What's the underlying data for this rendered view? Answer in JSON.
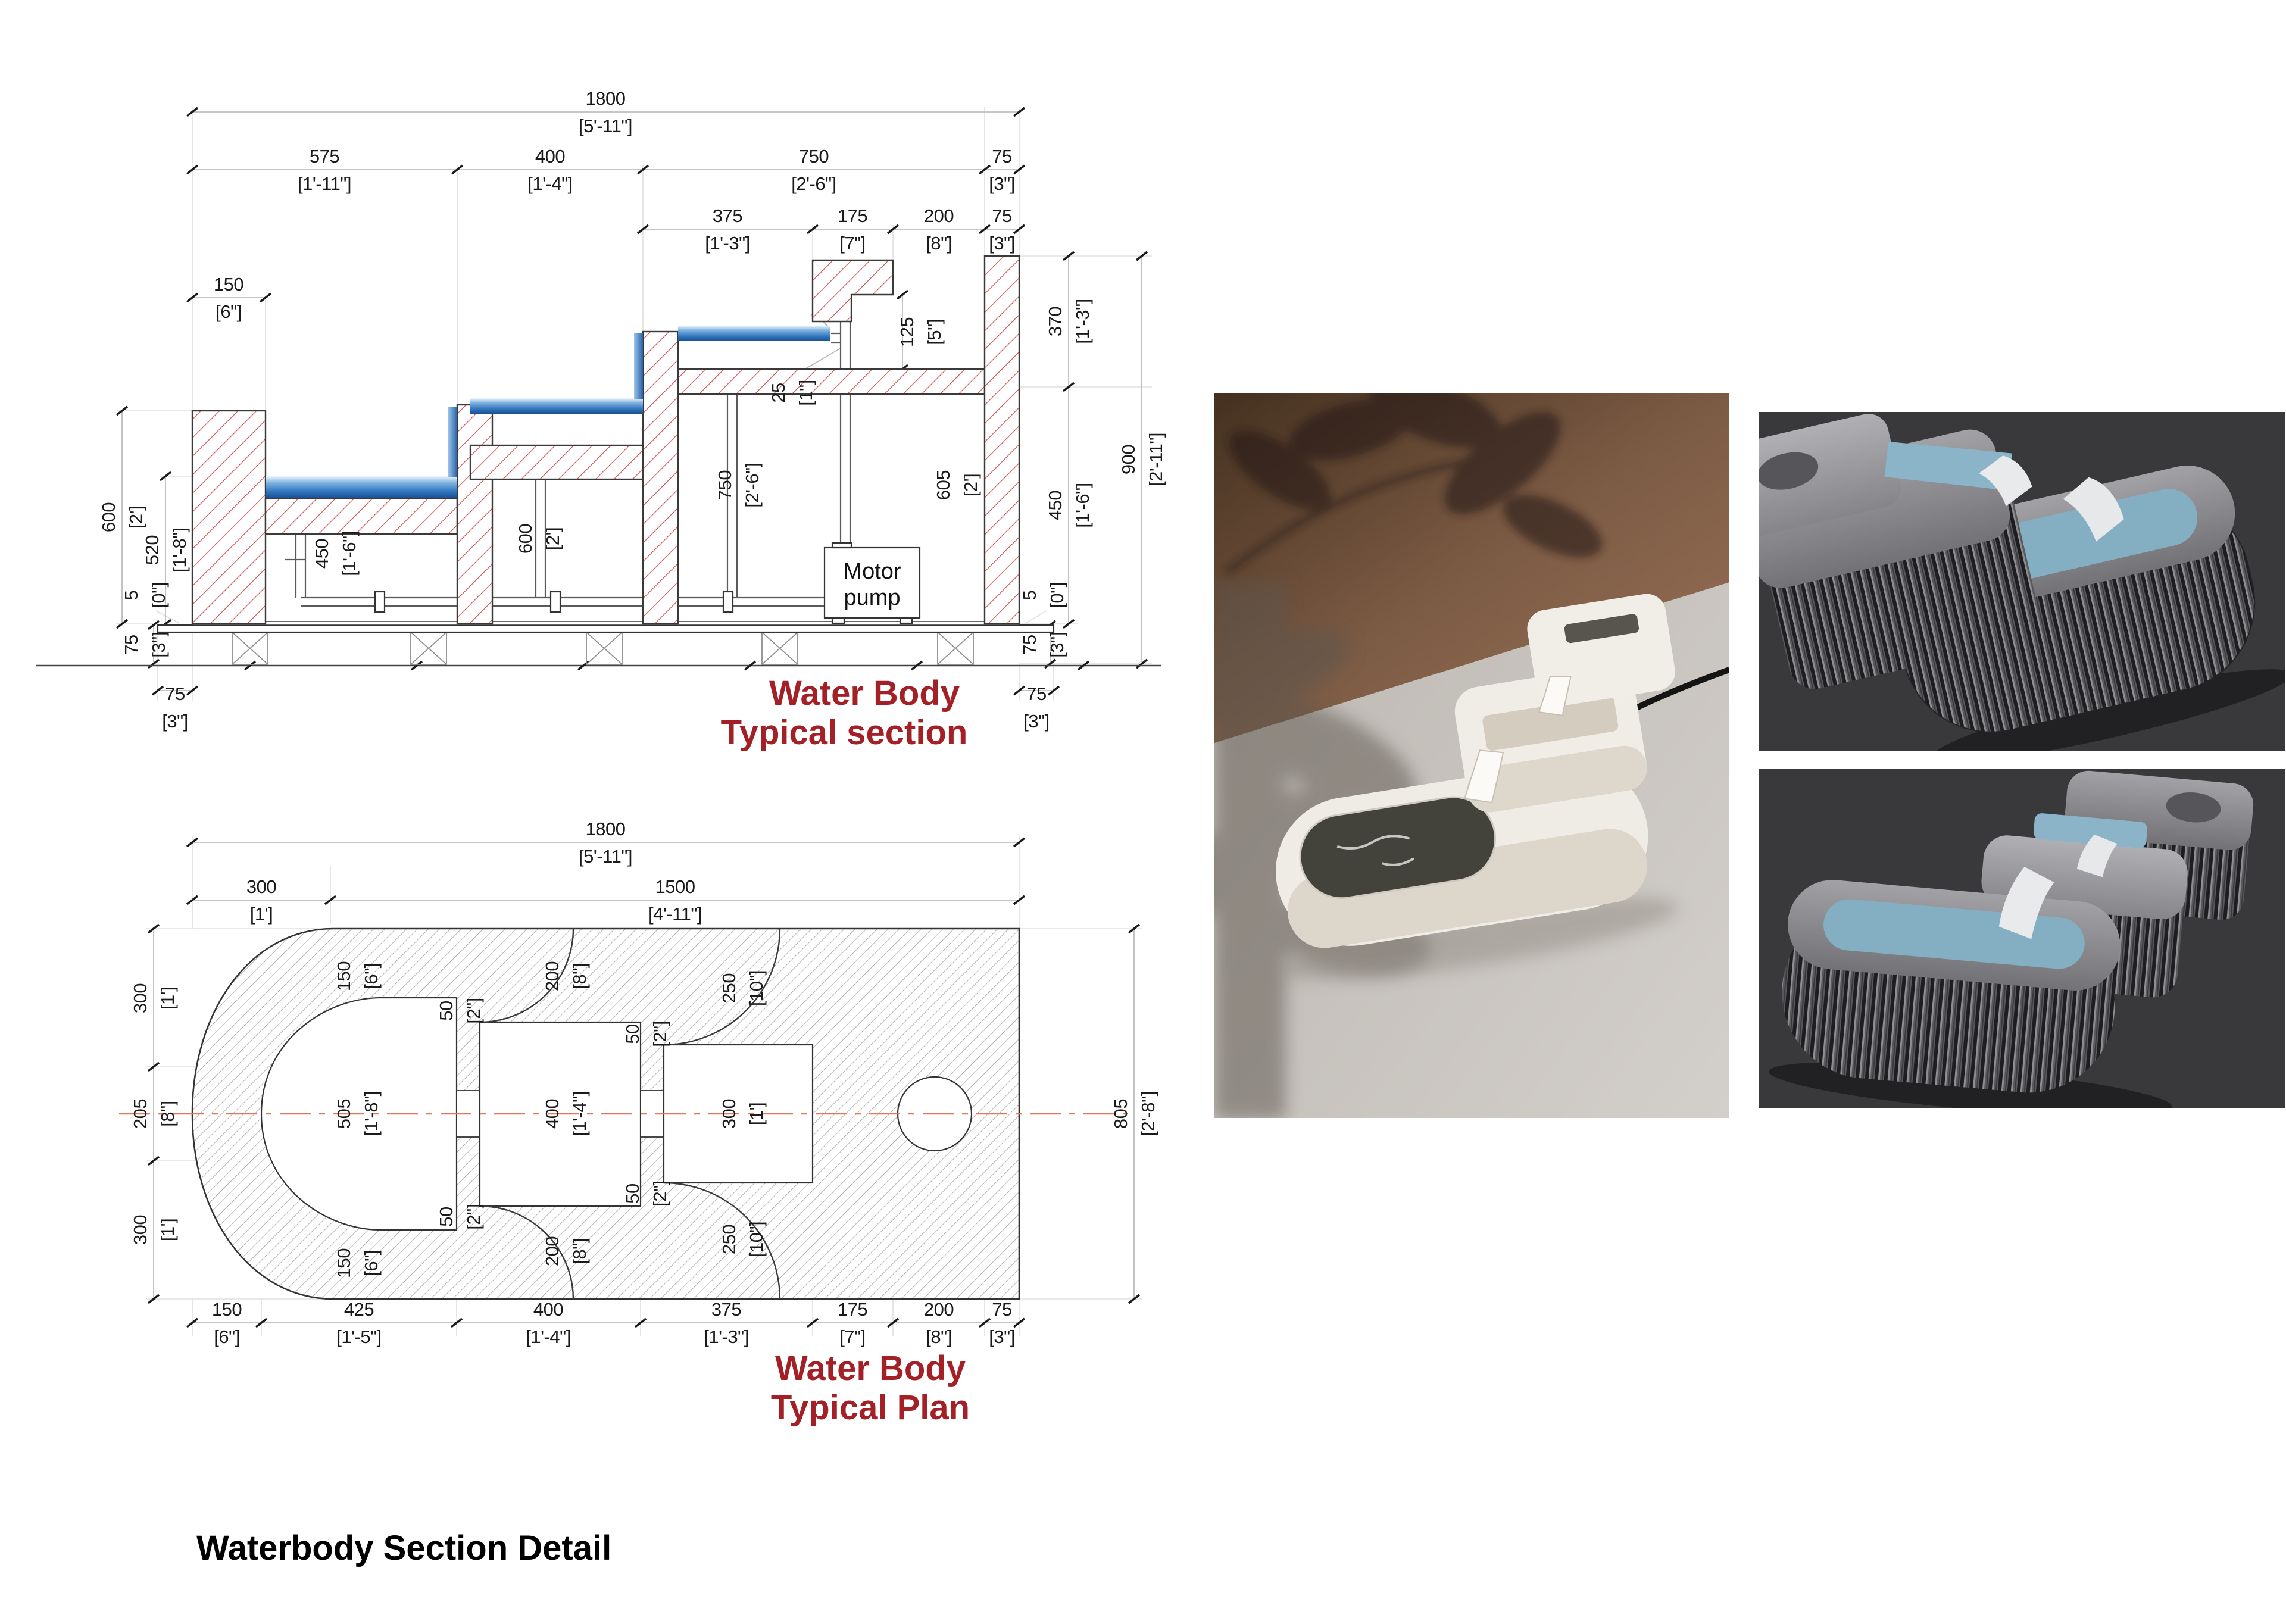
{
  "colors": {
    "title_red": "#A32126",
    "hatch_red": "#CC4A4A",
    "water_blue": "#2F74BC",
    "plan_centerline": "#E07A5F",
    "render_bg": "#39393B"
  },
  "caption": "Waterbody Section Detail",
  "section": {
    "title1": "Water Body",
    "title2": "Typical section",
    "pump1": "Motor",
    "pump2": "pump",
    "dims": {
      "total": {
        "mm": "1800",
        "ft": "[5'-11\"]"
      },
      "w575": {
        "mm": "575",
        "ft": "[1'-11\"]"
      },
      "w400": {
        "mm": "400",
        "ft": "[1'-4\"]"
      },
      "w750": {
        "mm": "750",
        "ft": "[2'-6\"]"
      },
      "w75a": {
        "mm": "75",
        "ft": "[3\"]"
      },
      "w375": {
        "mm": "375",
        "ft": "[1'-3\"]"
      },
      "w175": {
        "mm": "175",
        "ft": "[7\"]"
      },
      "w200": {
        "mm": "200",
        "ft": "[8\"]"
      },
      "w75b": {
        "mm": "75",
        "ft": "[3\"]"
      },
      "w150": {
        "mm": "150",
        "ft": "[6\"]"
      },
      "h125": {
        "mm": "125",
        "ft": "[5\"]"
      },
      "h25": {
        "mm": "25",
        "ft": "[1\"]"
      },
      "h370": {
        "mm": "370",
        "ft": "[1'-3\"]"
      },
      "h900": {
        "mm": "900",
        "ft": "[2'-11\"]"
      },
      "h450r": {
        "mm": "450",
        "ft": "[1'-6\"]"
      },
      "h5r": {
        "mm": "5",
        "ft": "[0\"]"
      },
      "h75r": {
        "mm": "75",
        "ft": "[3\"]"
      },
      "w75bl": {
        "mm": "75",
        "ft": "[3\"]"
      },
      "w75br": {
        "mm": "75",
        "ft": "[3\"]"
      },
      "h600l": {
        "mm": "600",
        "ft": "[2']"
      },
      "h520l": {
        "mm": "520",
        "ft": "[1'-8\"]"
      },
      "h5l": {
        "mm": "5",
        "ft": "[0\"]"
      },
      "h75l": {
        "mm": "75",
        "ft": "[3\"]"
      },
      "d450": {
        "mm": "450",
        "ft": "[1'-6\"]"
      },
      "d600": {
        "mm": "600",
        "ft": "[2']"
      },
      "d750": {
        "mm": "750",
        "ft": "[2'-6\"]"
      },
      "d605": {
        "mm": "605",
        "ft": "[2']"
      }
    }
  },
  "plan": {
    "title1": "Water Body",
    "title2": "Typical Plan",
    "dims": {
      "total": {
        "mm": "1800",
        "ft": "[5'-11\"]"
      },
      "t300": {
        "mm": "300",
        "ft": "[1']"
      },
      "t1500": {
        "mm": "1500",
        "ft": "[4'-11\"]"
      },
      "l300a": {
        "mm": "300",
        "ft": "[1']"
      },
      "l205": {
        "mm": "205",
        "ft": "[8\"]"
      },
      "l300b": {
        "mm": "300",
        "ft": "[1']"
      },
      "r805": {
        "mm": "805",
        "ft": "[2'-8\"]"
      },
      "i150t": {
        "mm": "150",
        "ft": "[6\"]"
      },
      "i50tl": {
        "mm": "50",
        "ft": "[2\"]"
      },
      "i505": {
        "mm": "505",
        "ft": "[1'-8\"]"
      },
      "i50bl": {
        "mm": "50",
        "ft": "[2\"]"
      },
      "i150b": {
        "mm": "150",
        "ft": "[6\"]"
      },
      "i200t": {
        "mm": "200",
        "ft": "[8\"]"
      },
      "i400": {
        "mm": "400",
        "ft": "[1'-4\"]"
      },
      "i200b": {
        "mm": "200",
        "ft": "[8\"]"
      },
      "i250t": {
        "mm": "250",
        "ft": "[10\"]"
      },
      "i50tr": {
        "mm": "50",
        "ft": "[2\"]"
      },
      "i300": {
        "mm": "300",
        "ft": "[1']"
      },
      "i50br": {
        "mm": "50",
        "ft": "[2\"]"
      },
      "i250b": {
        "mm": "250",
        "ft": "[10\"]"
      },
      "b150": {
        "mm": "150",
        "ft": "[6\"]"
      },
      "b425": {
        "mm": "425",
        "ft": "[1'-5\"]"
      },
      "b400": {
        "mm": "400",
        "ft": "[1'-4\"]"
      },
      "b375": {
        "mm": "375",
        "ft": "[1'-3\"]"
      },
      "b175": {
        "mm": "175",
        "ft": "[7\"]"
      },
      "b200": {
        "mm": "200",
        "ft": "[8\"]"
      },
      "b75": {
        "mm": "75",
        "ft": "[3\"]"
      }
    }
  }
}
